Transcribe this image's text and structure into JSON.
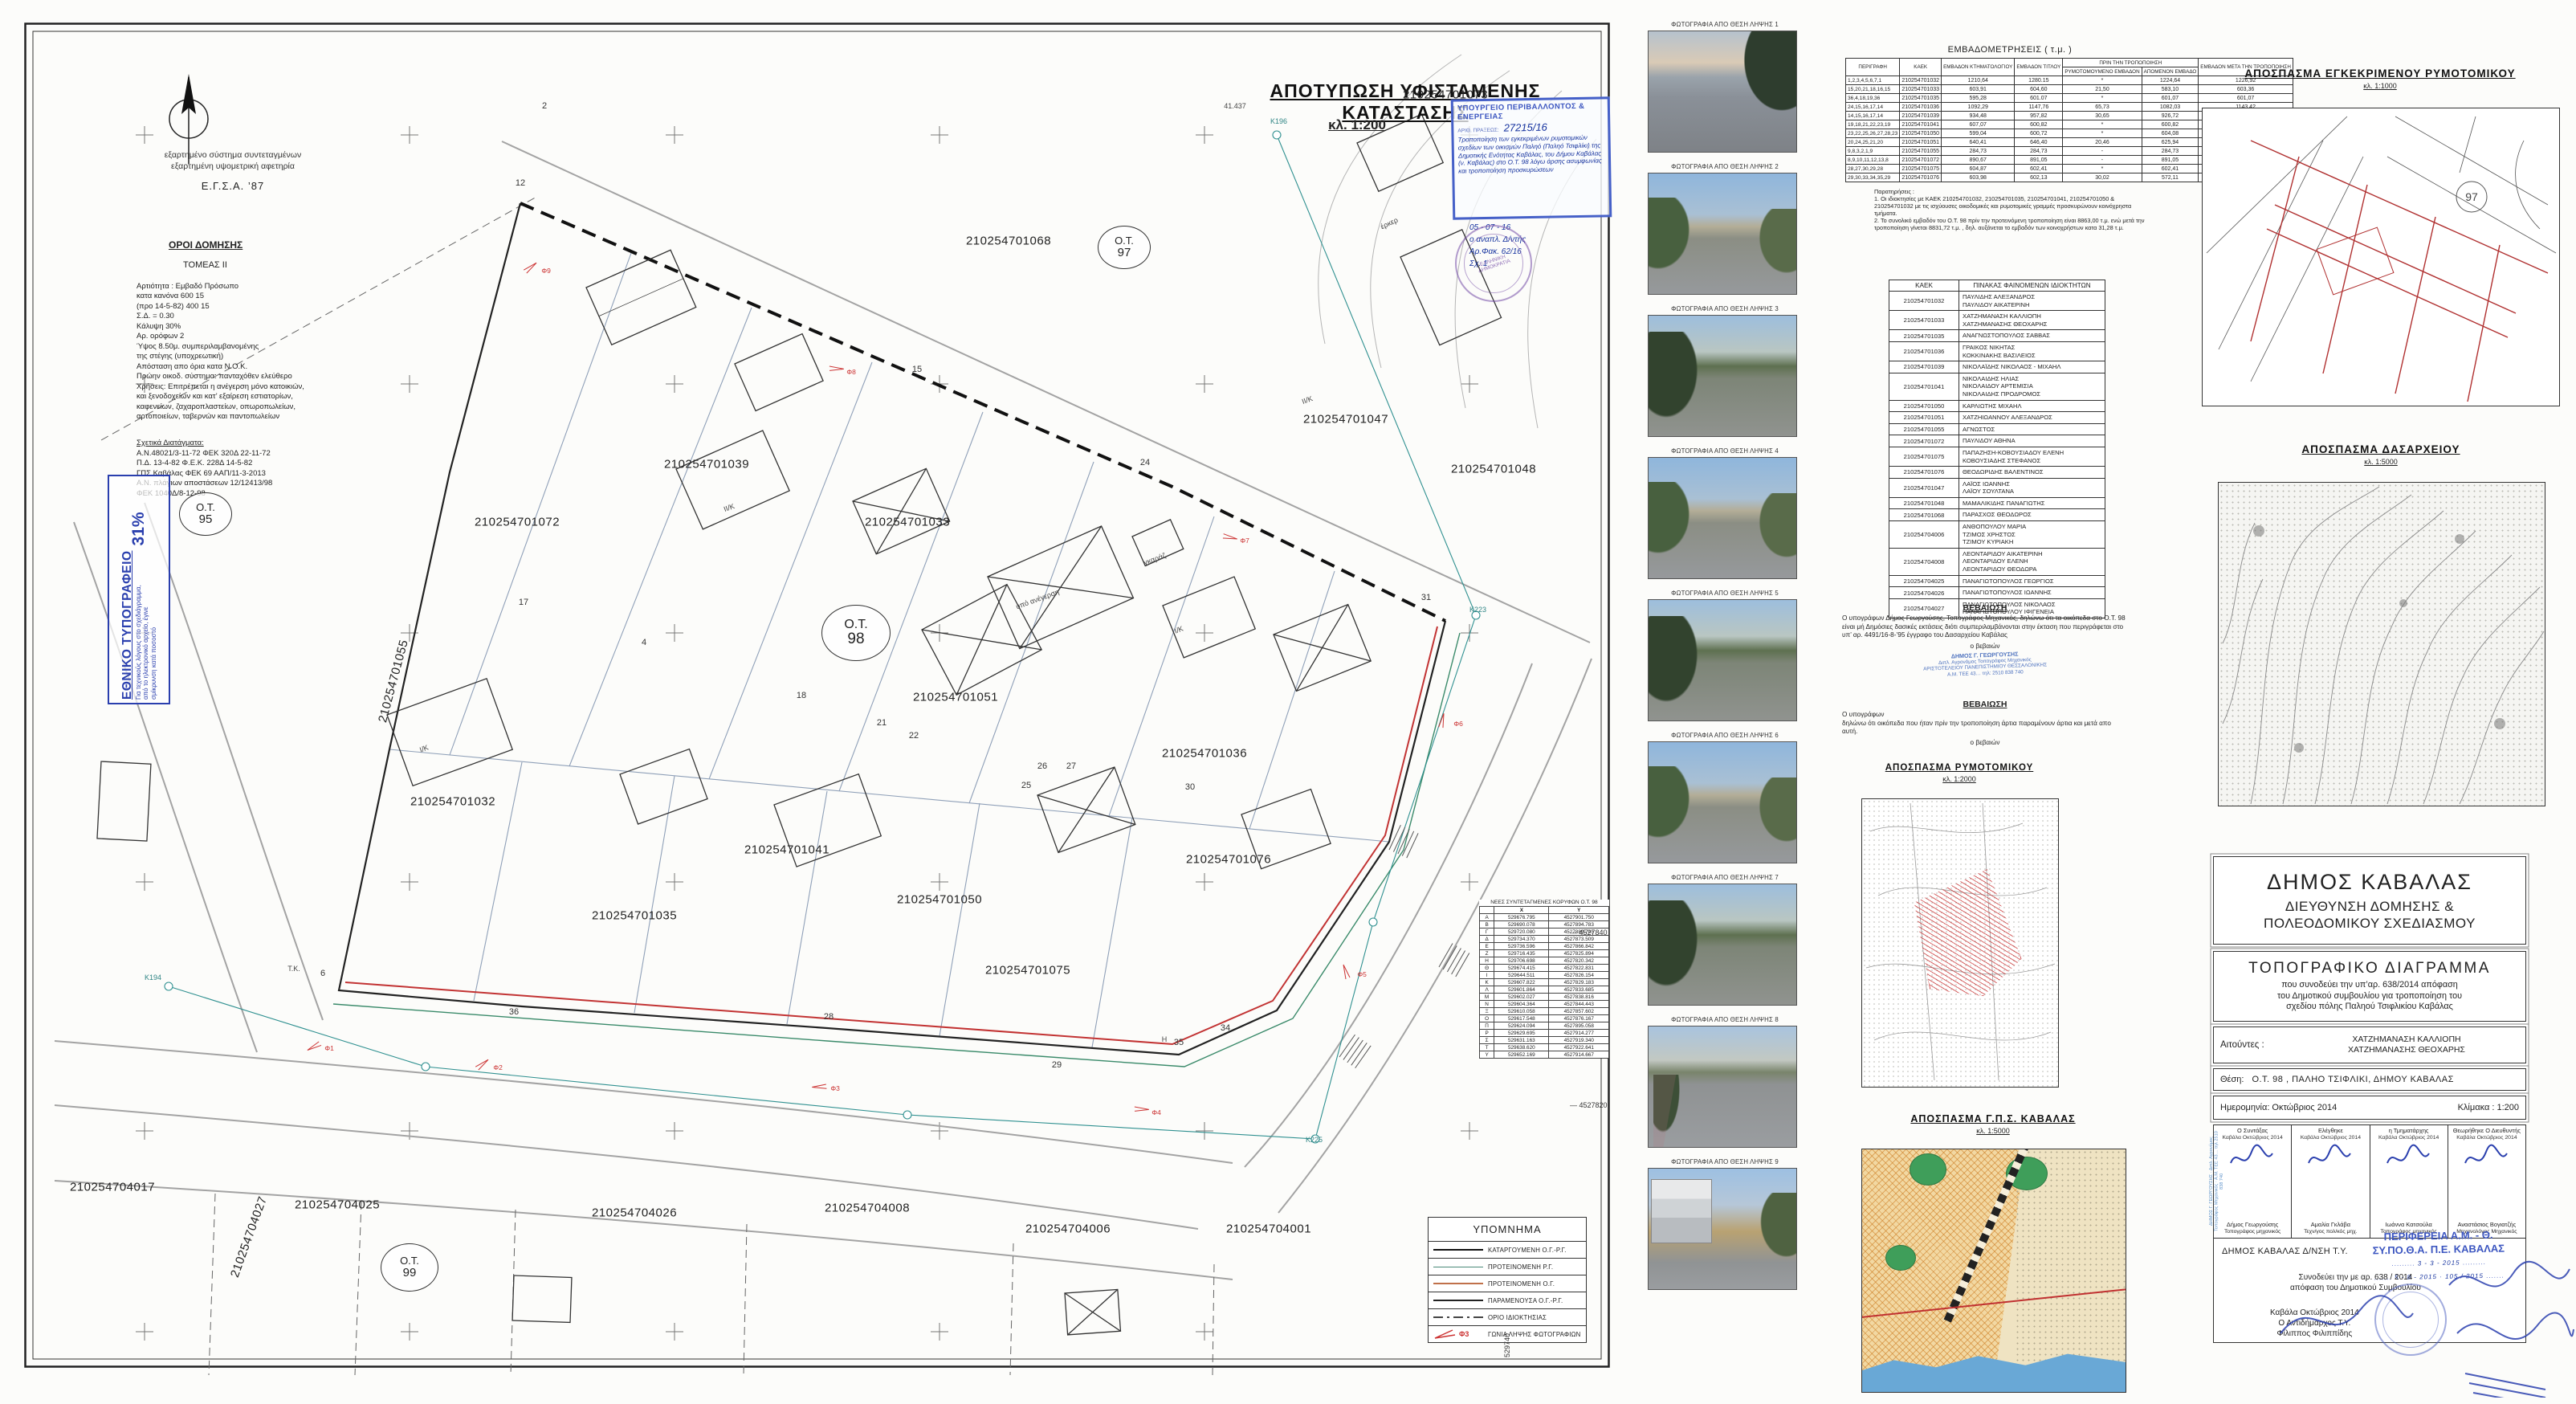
{
  "map": {
    "title": "ΑΠΟΤΥΠΩΣΗ ΥΦΙΣΤΑΜΕΝΗΣ ΚΑΤΑΣΤΑΣΗΣ",
    "scale": "κλ. 1:200",
    "coord_note1": "εξαρτημένο σύστημα συντεταγμένων",
    "coord_note2": "εξαρτημένη υψομετρική αφετηρία",
    "coord_system": "Ε.Γ.Σ.Α. ’87",
    "oroi": {
      "title": "ΟΡΟΙ ΔΟΜΗΣΗΣ",
      "tomeas": "ΤΟΜΕΑΣ  II",
      "lines": "Αρτιότητα :    Εμβαδό    Πρόσωπο\nκατα κανόνα       600            15\n(προ 14-5-82)     400            15\nΣ.Δ.  =  0.30\nΚάλυψη            30%\nΑρ. ορόφων     2\nΎψος          8.50μ. συμπεριλαμβανομένης\n                     της στέγης (υποχρεωτική)\nΑπόσταση απο όρια κατα Ν.Ο.Κ.\nΠρώην οικοδ. σύστημα: πανταχόθεν ελεύθερο\nΧρήσεις: Επιτρέπεται η ανέγερση μόνο κατοικιών,\nκαι ξενοδοχείων και κατ’ εξαίρεση εστιατορίων,\nκαφενείων, ζαχαροπλαστείων, οπωροπωλείων,\nαρτοποιείων, ταβερνών και παντοπωλείων",
      "decrees_title": "Σχετικά Διατάγματα:",
      "decrees": "Α.Ν.48021/3-11-72 ΦΕΚ 320Δ 22-11-72\nΠ.Δ. 13-4-82 Φ.Ε.Κ. 228Δ 14-5-82\nΓΠΣ Καβάλας ΦΕΚ 69 ΑΑΠ/11-3-2013\nΑ.Ν. πλάγιων αποστάσεων 12/12413/98\n      ΦΕΚ 1040Δ/8-12-98"
    },
    "ethniko": {
      "title": "ΕΘΝΙΚΟ ΤΥΠΟΓΡΑΦΕΙΟ",
      "note": "Για τεχνικούς λόγους στο σχεδιάγραμμα, από το ηλεκτρονικό αρχείο, έγινε σμίκρυνση κατά ποσοστό",
      "percent": "31%"
    },
    "ministry_stamp": {
      "title": "ΥΠΟΥΡΓΕΙΟ ΠΕΡΙΒΑΛΛΟΝΤΟΣ & ΕΝΕΡΓΕΙΑΣ",
      "praxis_label": "ΑΡΙΘ. ΠΡΑΞΕΩΣ:",
      "praxis_no": "27215/16",
      "hw_lines": "Τροποποίηση των εγκεκριμένων ρυμοτομικών σχεδίων των οικισμών Παληό (Παληό Τσιφλίκι) της Δημοτικής Ενότητας Καβάλας, του Δήμου Καβάλας (ν. Καβάλας) στο Ο.Τ. 98 λόγω άρσης ασυμφωνίας και τροποποίηση προσκυρώσεων",
      "hw_date": "05 - 07 - 16",
      "hw_role": "ο αναπλ. Δ/ντής",
      "hw_fak": "Αρ.Φακ.  62/16",
      "hw_sx": "Σχ. 1",
      "round_stamp_text": "ΕΛΛΗΝΙΚΗ ΔΗΜΟΚΡΑΤΙΑ"
    },
    "ot_circles": [
      {
        "top": "Ο.Τ.",
        "num": "95"
      },
      {
        "top": "Ο.Τ.",
        "num": "97"
      },
      {
        "top": "Ο.Τ.",
        "num": "98"
      },
      {
        "top": "Ο.Τ.",
        "num": "99"
      }
    ],
    "parcels": [
      "210254701073",
      "210254701068",
      "210254701047",
      "210254701048",
      "210254701039",
      "210254701033",
      "210254701072",
      "210254701055",
      "210254701051",
      "210254701036",
      "210254701032",
      "210254701041",
      "210254701076",
      "210254701035",
      "210254701050",
      "210254701075",
      "210254704017",
      "210254704027",
      "210254704025",
      "210254704026",
      "210254704008",
      "210254704006",
      "210254704001"
    ],
    "vertex_numbers": [
      "2",
      "12",
      "15",
      "24",
      "31",
      "17",
      "4",
      "18",
      "21",
      "22",
      "25",
      "26",
      "27",
      "30",
      "28",
      "29",
      "35",
      "6",
      "36",
      "34"
    ],
    "control_points": [
      "Κ196",
      "Κ223",
      "Κ194",
      "Κ225"
    ],
    "building_labels": [
      "υπό ανέγερση",
      "ΙΙ/Κ",
      "Ι/Κ",
      "ΙΙ/Κ",
      "Ι/Κ",
      "γκαράζ",
      "έρκερ",
      "Τ.Κ.",
      "Η",
      "41.437"
    ],
    "photo_angles": [
      "Φ1",
      "Φ2",
      "Φ3",
      "Φ4",
      "Φ5",
      "Φ6",
      "Φ7",
      "Φ8",
      "Φ9"
    ],
    "grid_labels_right": [
      "4527840",
      "4527820"
    ],
    "grid_label_bottom": "529740",
    "vertex_table": {
      "title": "ΝΕΕΣ ΣΥΝΤΕΤΑΓΜΕΝΕΣ ΚΟΡΥΦΩΝ Ο.Τ. 98",
      "headers": [
        "",
        "X",
        "Y"
      ],
      "rows": [
        [
          "Α",
          "529676.795",
          "4527901.750"
        ],
        [
          "Β",
          "529690.078",
          "4527894.783"
        ],
        [
          "Γ",
          "529720.080",
          "4527880.745"
        ],
        [
          "Δ",
          "529734.370",
          "4527873.509"
        ],
        [
          "Ε",
          "529736.596",
          "4527866.842"
        ],
        [
          "Ζ",
          "529716.435",
          "4527825.894"
        ],
        [
          "Η",
          "529706.698",
          "4527820.342"
        ],
        [
          "Θ",
          "529674.415",
          "4527822.831"
        ],
        [
          "Ι",
          "529644.511",
          "4527826.154"
        ],
        [
          "Κ",
          "529607.822",
          "4527829.183"
        ],
        [
          "Λ",
          "529601.864",
          "4527833.685"
        ],
        [
          "Μ",
          "529602.027",
          "4527838.816"
        ],
        [
          "Ν",
          "529604.364",
          "4527844.443"
        ],
        [
          "Ξ",
          "529610.058",
          "4527857.602"
        ],
        [
          "Ο",
          "529617.548",
          "4527876.167"
        ],
        [
          "Π",
          "529624.094",
          "4527895.058"
        ],
        [
          "Ρ",
          "529629.695",
          "4527914.277"
        ],
        [
          "Σ",
          "529631.163",
          "4527919.340"
        ],
        [
          "Τ",
          "529638.620",
          "4527922.641"
        ],
        [
          "Υ",
          "529652.169",
          "4527914.667"
        ]
      ]
    },
    "legend": {
      "title": "ΥΠΟΜΝΗΜΑ",
      "items": [
        {
          "key": "katarg",
          "label": "ΚΑΤΑΡΓΟΥΜΕΝΗ  Ο.Γ.-Ρ.Γ."
        },
        {
          "key": "protrg",
          "label": "ΠΡΟΤΕΙΝΟΜΕΝΗ  Ρ.Γ."
        },
        {
          "key": "protog",
          "label": "ΠΡΟΤΕΙΝΟΜΕΝΗ  Ο.Γ."
        },
        {
          "key": "param",
          "label": "ΠΑΡΑΜΕΝΟΥΣΑ  Ο.Γ.-Ρ.Γ."
        },
        {
          "key": "orio",
          "label": "ΟΡΙΟ ΙΔΙΟΚΤΗΣΙΑΣ"
        },
        {
          "key": "photo",
          "label": "ΓΩΝΙΑ ΛΗΨΗΣ ΦΩΤΟΓΡΑΦΙΩΝ",
          "extra": "Φ3"
        }
      ]
    }
  },
  "photos": {
    "captions": [
      "ΦΩΤΟΓΡΑΦΙΑ ΑΠΟ ΘΕΣΗ ΛΗΨΗΣ 1",
      "ΦΩΤΟΓΡΑΦΙΑ ΑΠΟ ΘΕΣΗ ΛΗΨΗΣ 2",
      "ΦΩΤΟΓΡΑΦΙΑ ΑΠΟ ΘΕΣΗ ΛΗΨΗΣ 3",
      "ΦΩΤΟΓΡΑΦΙΑ ΑΠΟ ΘΕΣΗ ΛΗΨΗΣ 4",
      "ΦΩΤΟΓΡΑΦΙΑ ΑΠΟ ΘΕΣΗ ΛΗΨΗΣ 5",
      "ΦΩΤΟΓΡΑΦΙΑ ΑΠΟ ΘΕΣΗ ΛΗΨΗΣ 6",
      "ΦΩΤΟΓΡΑΦΙΑ ΑΠΟ ΘΕΣΗ ΛΗΨΗΣ 7",
      "ΦΩΤΟΓΡΑΦΙΑ ΑΠΟ ΘΕΣΗ ΛΗΨΗΣ 8",
      "ΦΩΤΟΓΡΑΦΙΑ ΑΠΟ ΘΕΣΗ ΛΗΨΗΣ 9"
    ]
  },
  "areas_table": {
    "title": "ΕΜΒΑΔΟΜΕΤΡΗΣΕΙΣ ( τ.μ. )",
    "group_header": "ΠΡΙΝ ΤΗΝ ΤΡΟΠΟΠΟΙΗΣΗ",
    "headers": [
      "ΠΕΡΙΓΡΑΦΗ",
      "ΚΑΕΚ",
      "ΕΜΒΑΔΟΝ ΚΤΗΜΑΤΟΛΟΓΙΟΥ",
      "ΕΜΒΑΔΟΝ ΤΙΤΛΟΥ",
      "ΡΥΜΟΤΟΜΟΥΜΕΝΟ ΕΜΒΑΔΟΝ",
      "ΑΠΟΜΕΝΟΝ ΕΜΒΑΔΟ",
      "ΕΜΒΑΔΟΝ ΜΕΤΑ ΤΗΝ ΤΡΟΠΟΠΟΙΗΣΗ"
    ],
    "rows": [
      [
        "1,2,3,4,5,6,7,1",
        "210254701032",
        "1210,64",
        "1280.15",
        "*",
        "1224,64",
        "1226,92"
      ],
      [
        "15,20,21,18,16,15",
        "210254701033",
        "603,91",
        "604,60",
        "21,50",
        "583,10",
        "603,36"
      ],
      [
        "36,4,18,19,36",
        "210254701035",
        "595,28",
        "601.07",
        "*",
        "601,07",
        "601,07"
      ],
      [
        "24,15,16,17,14",
        "210254701036",
        "1092,29",
        "1147,76",
        "65,73",
        "1082,03",
        "1143,42"
      ],
      [
        "14,15,16,17,14",
        "210254701039",
        "934,48",
        "957,82",
        "30,65",
        "926,72",
        "948,13"
      ],
      [
        "19,18,21,22,23,19",
        "210254701041",
        "607,07",
        "600,82",
        "*",
        "600,82",
        "600,42"
      ],
      [
        "23,22,25,26,27,28,23",
        "210254701050",
        "599,04",
        "600,72",
        "*",
        "604,08",
        "602,54"
      ],
      [
        "20,24,25,21,20",
        "210254701051",
        "640,41",
        "646,40",
        "20,46",
        "625,94",
        "641,44"
      ],
      [
        "9,8,3,2,1,9",
        "210254701055",
        "284,73",
        "284,73",
        "-",
        "284,73",
        "284,73"
      ],
      [
        "8,9,10,11,12,13,8",
        "210254701072",
        "890,67",
        "891,05",
        "-",
        "891,05",
        "890,69"
      ],
      [
        "28,27,30,29,28",
        "210254701075",
        "604,87",
        "602,41",
        "*",
        "602,41",
        "603,56"
      ],
      [
        "29,30,33,34,35,29",
        "210254701076",
        "603,98",
        "602,13",
        "30,02",
        "572,11",
        "601,66"
      ]
    ],
    "notes_label": "Παρατηρήσεις :",
    "note1": "1. Οι ιδιοκτησίες με ΚΑΕΚ 210254701032, 210254701035, 210254701041, 210254701050 & 210254701032 με τις ισχύουσες οικοδομικές και ρυμοτομικές γραμμές προσκυρώνουν κοινόχρηστα τμήματα.",
    "note2": "2. Το συνολικό εμβαδόν του Ο.Τ. 98 πρίν την προτεινόμενη τροποποίηση είναι 8863,00 τ.μ. ενώ μετά την τροποποίηση γίνεται 8831,72 τ.μ. , δηλ. αυξάνεται το εμβαδόν των κοινοχρήστων κατα 31,28 τ.μ."
  },
  "owners_table": {
    "col1": "ΚΑΕΚ",
    "col2": "ΠΙΝΑΚΑΣ ΦΑΙΝΟΜΕΝΩΝ ΙΔΙΟΚΤΗΤΩΝ",
    "rows": [
      {
        "kaek": "210254701032",
        "names": [
          "ΠΑΥΛΙΔΗΣ ΑΛΕΞΑΝΔΡΟΣ",
          "ΠΑΥΛΙΔΟΥ ΑΙΚΑΤΕΡΙΝΗ"
        ]
      },
      {
        "kaek": "210254701033",
        "names": [
          "ΧΑΤΖΗΜΑΝΑΣΗ ΚΑΛΛΙΟΠΗ",
          "ΧΑΤΖΗΜΑΝΑΣΗΣ ΘΕΟΧΑΡΗΣ"
        ]
      },
      {
        "kaek": "210254701035",
        "names": [
          "ΑΝΑΓΝΩΣΤΟΠΟΥΛΟΣ ΣΑΒΒΑΣ"
        ]
      },
      {
        "kaek": "210254701036",
        "names": [
          "ΓΡΑΙΚΟΣ ΝΙΚΗΤΑΣ",
          "ΚΟΚΚΙΝΑΚΗΣ ΒΑΣΙΛΕΙΟΣ"
        ]
      },
      {
        "kaek": "210254701039",
        "names": [
          "ΝΙΚΟΛΑΪΔΗΣ ΝΙΚΟΛΑΟΣ - ΜΙΧΑΗΛ"
        ]
      },
      {
        "kaek": "210254701041",
        "names": [
          "ΝΙΚΟΛΑΙΔΗΣ ΗΛΙΑΣ",
          "ΝΙΚΟΛΑΙΔΟΥ ΑΡΤΕΜΙΣΙΑ",
          "ΝΙΚΟΛΑΙΔΗΣ ΠΡΟΔΡΟΜΟΣ"
        ]
      },
      {
        "kaek": "210254701050",
        "names": [
          "ΚΑΡΛΙΩΤΗΣ ΜΙΧΑΗΛ"
        ]
      },
      {
        "kaek": "210254701051",
        "names": [
          "ΧΑΤΖΗΙΩΑΝΝΟΥ ΑΛΕΞΑΝΔΡΟΣ"
        ]
      },
      {
        "kaek": "210254701055",
        "names": [
          "ΑΓΝΩΣΤΟΣ"
        ]
      },
      {
        "kaek": "210254701072",
        "names": [
          "ΠΑΥΛΙΔΟΥ ΑΘΗΝΑ"
        ]
      },
      {
        "kaek": "210254701075",
        "names": [
          "ΠΑΠΑΖΗΣΗ-ΚΟΒΟΥΣΙΑΔΟΥ ΕΛΕΝΗ",
          "ΚΟΒΟΥΣΙΑΔΗΣ ΣΤΕΦΑΝΟΣ"
        ]
      },
      {
        "kaek": "210254701076",
        "names": [
          "ΘΕΟΔΩΡΙΔΗΣ ΒΑΛΕΝΤΙΝΟΣ"
        ]
      },
      {
        "kaek": "210254701047",
        "names": [
          "ΛΑΪΟΣ ΙΩΑΝΝΗΣ",
          "ΛΑΪΟΥ ΣΟΥΛΤΑΝΑ"
        ]
      },
      {
        "kaek": "210254701048",
        "names": [
          "ΜΑΜΑΛΙΚΙΔΗΣ ΠΑΝΑΓΙΩΤΗΣ"
        ]
      },
      {
        "kaek": "210254701068",
        "names": [
          "ΠΑΡΑΣΧΟΣ ΘΕΟΔΩΡΟΣ"
        ]
      },
      {
        "kaek": "210254704006",
        "names": [
          "ΑΝΘΟΠΟΥΛΟΥ ΜΑΡΙΑ",
          "ΤΖΙΜΟΣ ΧΡΗΣΤΟΣ",
          "ΤΖΙΜΟΥ ΚΥΡΙΑΚΗ"
        ]
      },
      {
        "kaek": "210254704008",
        "names": [
          "ΛΕΟΝΤΑΡΙΔΟΥ ΑΙΚΑΤΕΡΙΝΗ",
          "ΛΕΟΝΤΑΡΙΔΟΥ ΕΛΕΝΗ",
          "ΛΕΟΝΤΑΡΙΔΟΥ ΘΕΟΔΩΡΑ"
        ]
      },
      {
        "kaek": "210254704025",
        "names": [
          "ΠΑΝΑΓΙΩΤΟΠΟΥΛΟΣ ΓΕΩΡΓΙΟΣ"
        ]
      },
      {
        "kaek": "210254704026",
        "names": [
          "ΠΑΝΑΓΙΩΤΟΠΟΥΛΟΣ ΙΩΑΝΝΗΣ"
        ]
      },
      {
        "kaek": "210254704027",
        "names": [
          "ΠΑΝΑΓΙΩΤΟΠΟΥΛΟΣ ΝΙΚΟΛΑΟΣ",
          "ΠΑΝΑΓΙΩΤΟΠΟΥΛΟΥ ΙΦΙΓΕΝΕΙΑ"
        ]
      }
    ]
  },
  "cert1": {
    "title": "ΒΕΒΑΙΩΣΗ",
    "body": "Ο υπογράφων  Δήμος Γεωργούσης, Τοπογράφος  Μηχανικός, δηλώνω ότι τα οικόπεδα στο Ο.Τ. 98 είναι μή Δημόσιες δασικές εκτάσεις διότι συμπεριλαμβάνονται στην έκταση που περιγράφεται στο υπ’ αρ. 4491/16-8-’95 έγγραφο του Δασαρχείου Καβάλας",
    "signer": "ο βεβαιών",
    "stamp_l1": "ΔΗΜΟΣ Γ. ΓΕΩΡΓΟΥΣΗΣ",
    "stamp_l2": "Διπλ. Αγρονόμος Τοπογράφος Μηχανικός",
    "stamp_l3": "ΑΡΙΣΤΟΤΕΛΕΙΟΥ ΠΑΝΕΠΙΣΤΗΜΙΟΥ ΘΕΣΣΑΛΟΝΙΚΗΣ",
    "stamp_l4": "Α.Μ. ΤΕΕ 43…  τηλ: 2510 838 740"
  },
  "cert2": {
    "title": "ΒΕΒΑΙΩΣΗ",
    "intro": "Ο υπογράφων",
    "body": "δηλώνω ότι οικόπεδα που ήταν πρίν την τροποποίηση άρτια παραμένουν άρτια και μετά απο αυτή.",
    "signer": "ο βεβαιών"
  },
  "excerpts": {
    "rym": {
      "title": "ΑΠΟΣΠΑΣΜΑ   ΡΥΜΟΤΟΜΙΚΟΥ",
      "scale": "κλ.  1:2000"
    },
    "gps": {
      "title": "ΑΠΟΣΠΑΣΜΑ Γ.Π.Σ. ΚΑΒΑΛΑΣ",
      "scale": "κλ.  1:5000"
    },
    "egk": {
      "title": "ΑΠΟΣΠΑΣΜΑ  ΕΓΚΕΚΡΙΜΕΝΟΥ  ΡΥΜΟΤΟΜΙΚΟΥ",
      "scale": "κλ.  1:1000",
      "ot": "97"
    },
    "das": {
      "title": "ΑΠΟΣΠΑΣΜΑ  ΔΑΣΑΡΧΕΙΟΥ",
      "scale": "κλ.  1:5000"
    }
  },
  "title_block": {
    "municipality": "ΔΗΜΟΣ ΚΑΒΑΛΑΣ",
    "dept1": "ΔΙΕΥΘΥΝΣΗ ΔΟΜΗΣΗΣ &",
    "dept2": "ΠΟΛΕΟΔΟΜΙΚΟΥ ΣΧΕΔΙΑΣΜΟΥ",
    "doc_title": "ΤΟΠΟΓΡΑΦΙΚΟ  ΔΙΑΓΡΑΜΜΑ",
    "sub1": "που συνοδεύει την υπ’αρ.   638/2014 απόφαση",
    "sub2": "του Δημοτικού συμβουλίου για τροποποίηση του",
    "sub3": "σχεδίου  πόλης  Παληού  Τσιφλικίου Καβάλας",
    "applicants_label": "Αιτούντες :",
    "applicant1": "ΧΑΤΖΗΜΑΝΑΣΗ ΚΑΛΛΙΟΠΗ",
    "applicant2": "ΧΑΤΖΗΜΑΝΑΣΗΣ ΘΕΟΧΑΡΗΣ",
    "location_label": "Θέση:",
    "location": "Ο.Τ. 98 , ΠΑΛΗΟ ΤΣΙΦΛΙΚΙ,   ΔΗΜΟΥ ΚΑΒΑΛΑΣ",
    "date_label": "Ημερομηνία:  Οκτώβριος 2014",
    "scale_label": "Κλίμακα :  1:200"
  },
  "signatures": {
    "cols": [
      {
        "role": "Ο Συντάξας",
        "date": "Καβάλα Οκτώβριος 2014",
        "name": "Δήμος Γεωργούσης",
        "prof": "Τοπογράφος μηχανικός"
      },
      {
        "role": "Ελέγθηκε",
        "date": "Καβάλα Οκτώβριος 2014",
        "name": "Αμαλία Γκλάβα",
        "prof": "Τεχν/γος πολ/κός μηχ."
      },
      {
        "role": "η Τμηματάρχης",
        "date": "Καβάλα Οκτώβριος 2014",
        "name": "Ιωάννα Κατσούλα",
        "prof": "Τοπογράφος μηχανικός"
      },
      {
        "role": "Θεωρήθηκε Ο Διευθυντής",
        "date": "Καβάλα Οκτώβριος 2014",
        "name": "Αναστάσιος Βογιατζής",
        "prof": "Μηχανολόγος Μηχανικός"
      }
    ],
    "vstamp": "ΔΗΜΟΣ Γ. ΓΕΩΡΓΟΥΣΗΣ · Διπλ. Αγρονόμος Τοπογράφος Μηχανικός · Α.Μ. ΤΕΕ 43… τηλ 2510 838 740"
  },
  "approval": {
    "office": "ΔΗΜΟΣ ΚΑΒΑΛΑΣ Δ/ΝΣΗ Τ.Υ.",
    "acc1": "Συνοδεύει την με αρ. 638 / 2014",
    "acc2": "απόφαση του Δημοτικού Συμβουλίου",
    "place": "Καβάλα  Οκτώβριος 2014",
    "role": "Ο Αντιδήμαρχος Τ.Υ.",
    "name": "Φίλιππος Φιλιππίδης",
    "region1": "ΠΕΡΙΦΕΡΕΙΑ  Α.Μ. - Θ.",
    "region2": "ΣΥ.ΠΟ.Θ.Α.  Π.Ε. ΚΑΒΑΛΑΣ",
    "hw1": "3 - 3 - 2015",
    "hw2": "5 - 8 - 2015",
    "hw3": "105 / 2015"
  }
}
